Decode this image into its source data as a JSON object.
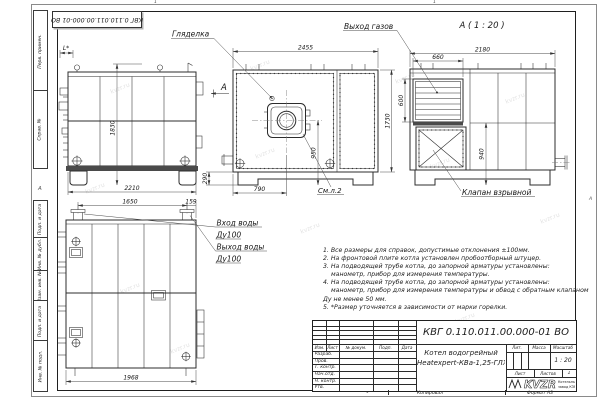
{
  "sheet": {
    "watermark": "kvzr.ru",
    "stamp_top": "КВГ 0.110.011.00.000-01 ВО",
    "zone_top_1": "1",
    "zone_top_2": "1",
    "zone_bottom": "1",
    "margin_letter_left": "А",
    "margin_letter_right": "А",
    "margin_fields": {
      "perv": "Перв. примен.",
      "sprav": "Справ. №",
      "podp1": "Подп. и дата",
      "inv_dubl": "Инв. № дубл.",
      "vzam": "Взам. инв. №",
      "podp2": "Подп. и дата",
      "inv_podl": "Инв. № подл."
    },
    "footer": {
      "copied": "Копировал",
      "format": "Формат А3"
    }
  },
  "views": {
    "side": {
      "section_label": "А",
      "dim_width": "2210",
      "dim_height": "1830",
      "dim_l": "L*"
    },
    "front": {
      "label_sight_glass": "Гляделка",
      "label_see_sheet": "См.л.2",
      "dim_width": "2455",
      "dim_height": "1730",
      "dim_burner_center": "950",
      "dim_burner_offset": "790",
      "dim_base": "290"
    },
    "a_view": {
      "title": "А ( 1 : 20 )",
      "label_gas_outlet": "Выход газов",
      "label_explosion_valve": "Клапан взрывной",
      "dim_width": "2180",
      "dim_louver_w": "660",
      "dim_louver_h": "600",
      "dim_lower": "940"
    },
    "rear": {
      "label_water_in": "Вход воды",
      "label_water_in_dn": "Ду100",
      "label_water_out": "Выход воды",
      "label_water_out_dn": "Ду100",
      "dim_pitch": "1650",
      "dim_edge": "159",
      "dim_width": "1968"
    }
  },
  "notes": {
    "lines": [
      "1. Все размеры для справок, допустимые отклонения ±100мм.",
      "2. На фронтовой плите котла установлен пробоотборный штуцер.",
      "3. На подводящей трубе котла, до запорной арматуры установлены:",
      "манометр, прибор для измерения температуры.",
      "4. На подводящей трубе котла, до запорной арматуры установлены:",
      "манометр, прибор для измерения температуры и обвод с обратным клапаном",
      "Ду не менее 50 мм.",
      "5. *Размер уточняется в зависимости от марки горелки."
    ]
  },
  "title_block": {
    "designation": "КВГ 0.110.011.00.000-01 ВО",
    "product_line1": "Котел водогрейный",
    "product_line2": "Heatexpert-КВа-1,25-ГЛЖ",
    "cols": {
      "izm": "Изм.",
      "list": "Лист",
      "doc": "№ докум.",
      "podp": "Подп.",
      "data": "Дата"
    },
    "rows": {
      "razrab": "Разраб.",
      "prov": "Пров.",
      "tkontr": "Т. контр.",
      "nachotd": "Нач.отд.",
      "nkontr": "Н. контр.",
      "utv": "Утв."
    },
    "lit_label": "Лит.",
    "mass_label": "Масса",
    "scale_label": "Масштаб",
    "scale_value": "1 : 20",
    "sheet_label": "Лист",
    "sheets_label": "Листов",
    "sheets_value": "1",
    "logo_text": "KVZR",
    "company_line1": "Котельный",
    "company_line2": "завод КЗР"
  }
}
